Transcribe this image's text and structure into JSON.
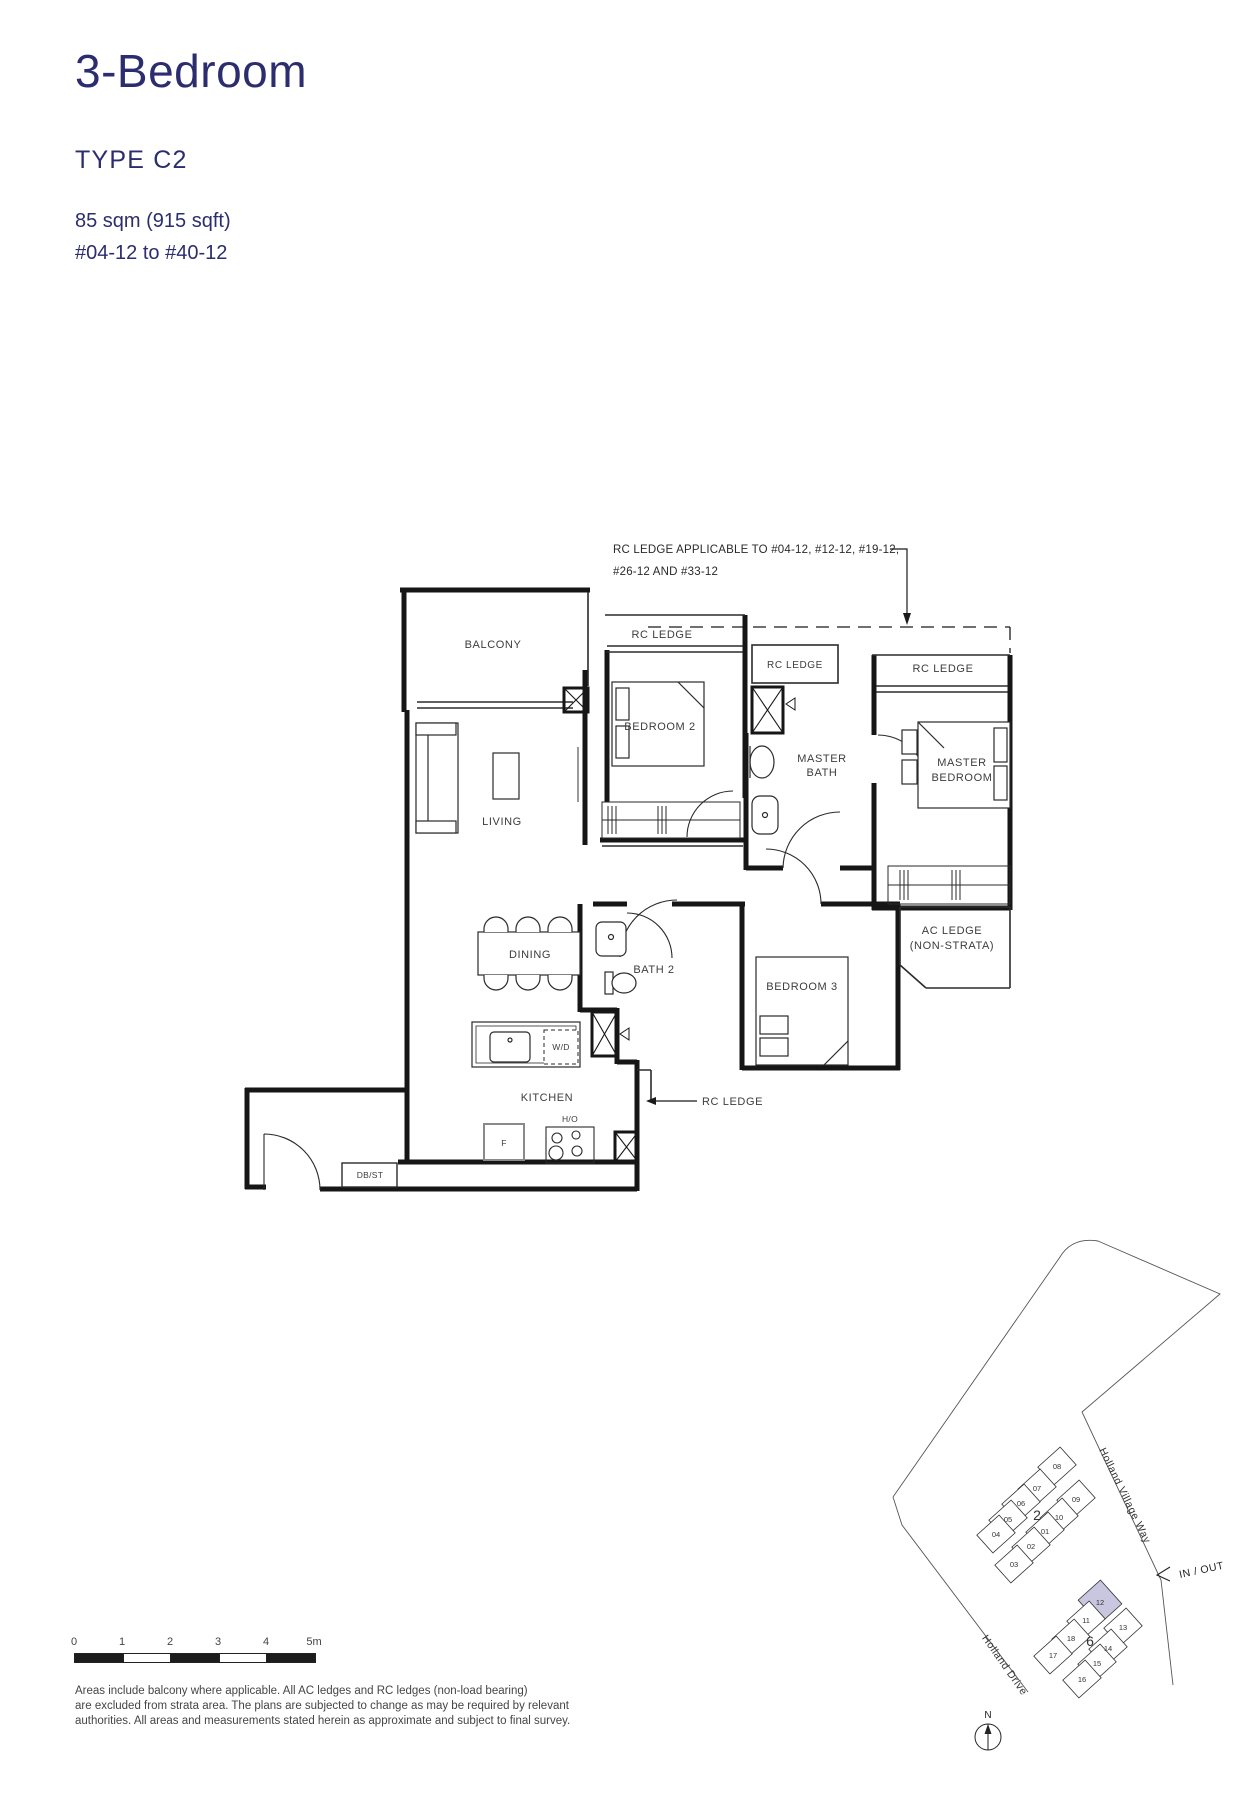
{
  "header": {
    "title": "3-Bedroom",
    "type_label": "TYPE C2",
    "area": "85 sqm (915 sqft)",
    "units": "#04-12 to #40-12"
  },
  "floor_plan": {
    "annotation_line1": "RC LEDGE APPLICABLE TO #04-12, #12-12, #19-12,",
    "annotation_line2": "#26-12 AND #33-12",
    "balcony": "BALCONY",
    "living": "LIVING",
    "dining": "DINING",
    "kitchen": "KITCHEN",
    "bedroom2": "BEDROOM 2",
    "bedroom3": "BEDROOM 3",
    "bath2": "BATH 2",
    "master_word": "MASTER",
    "bath_word": "BATH",
    "bedroom_word": "BEDROOM",
    "rc_ledge": "RC LEDGE",
    "ac_ledge_line1": "AC LEDGE",
    "ac_ledge_line2": "(NON-STRATA)",
    "wd": "W/D",
    "ho": "H/O",
    "fridge": "F",
    "dbst": "DB/ST"
  },
  "site_plan": {
    "road1": "Holland Village Way",
    "road2": "Holland Drive",
    "in_out": "IN / OUT",
    "north": "N",
    "block2_label": "2",
    "block6_label": "6",
    "block2_units": [
      "08",
      "07",
      "06",
      "05",
      "04",
      "09",
      "10",
      "01",
      "02",
      "03"
    ],
    "block6_units": [
      "12",
      "11",
      "13",
      "18",
      "14",
      "17",
      "15",
      "16"
    ],
    "highlighted_unit": "12",
    "highlight_color": "#c9c6e0"
  },
  "scale_bar": {
    "ticks": [
      "0",
      "1",
      "2",
      "3",
      "4",
      "5m"
    ]
  },
  "disclaimer": [
    "Areas include balcony where applicable. All AC ledges and RC ledges (non-load bearing)",
    "are excluded from strata area. The plans are subjected to change as may be required by relevant",
    "authorities. All areas and measurements stated herein as approximate and subject to final survey."
  ]
}
